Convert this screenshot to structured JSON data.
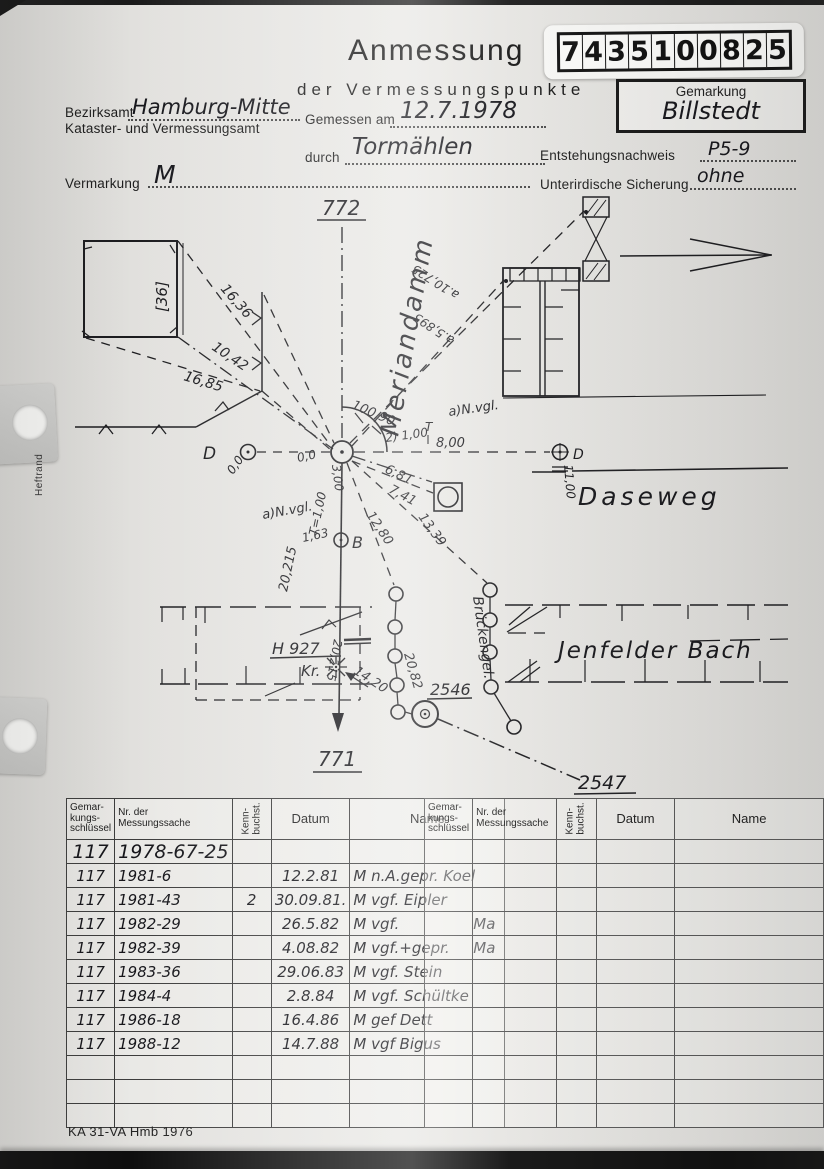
{
  "header": {
    "title_line1": "Anmessung",
    "title_line2": "der Vermessungspunkte",
    "stamp_digits": [
      "7",
      "4",
      "3",
      "5",
      "1",
      "0",
      "0",
      "8",
      "2",
      "5"
    ],
    "gemarkung_label": "Gemarkung",
    "gemarkung_value": "Billstedt",
    "bezirksamt_label": "Bezirksamt",
    "bezirksamt_value": "Hamburg-Mitte",
    "amt_label": "Kataster- und Vermessungsamt",
    "gemessen_label": "Gemessen am",
    "gemessen_value": "12.7.1978",
    "durch_label": "durch",
    "durch_value": "Tormählen",
    "vermarkung_label": "Vermarkung",
    "vermarkung_value": "M",
    "entstehung_label": "Entstehungsnachweis",
    "entstehung_value": "P5-9",
    "sicherung_label": "Unterirdische Sicherung",
    "sicherung_value": "ohne"
  },
  "margin": {
    "heftrand": "Heftrand"
  },
  "sketch": {
    "point_772": "772",
    "point_771": "771",
    "point_2546": "2546",
    "point_2547": "2547",
    "street_meriandamm": "Meriandamm",
    "street_daseweg": "Daseweg",
    "stream_name": "Jenfelder Bach",
    "bridge_abbr": "Brückengel.",
    "building_number": "[36]",
    "label_h927": "H 927",
    "label_kr": "Kr.",
    "label_b": "B",
    "label_d_left": "D",
    "label_d_right": "D",
    "angle_arc": "100,90",
    "note_2": "2) 1,00",
    "t_mark": "T",
    "nvgl_top": "a)N.vgl.",
    "nvgl_left": "a)N.vgl.",
    "t_100": "T=1,00",
    "m_16_36": "16,36",
    "m_10_42": "10,42",
    "m_16_85": "16,85",
    "m_8_00": "8,00",
    "m_6_81": "6,81",
    "m_7_41": "7,41",
    "m_12_80": "12,80",
    "m_13_39": "13,39",
    "m_10_725": "a.10,725",
    "m_5_895": "a.5,895",
    "m_0_0_left": "0,0",
    "m_0_0_center": "0,0",
    "m_3_00": "3,00",
    "m_1_63": "1,63",
    "m_20_215_a": "20,215",
    "m_20_215_b": "20,215",
    "m_11_00": "11,00",
    "m_14_20": "14,20",
    "m_20_82": "20,82"
  },
  "table": {
    "headers": {
      "col1": "Gemar-\nkungs-\nschlüssel",
      "col2": "Nr. der\nMessungssache",
      "col3": "Kenn-\nbuchst.",
      "col4": "Datum",
      "col5": "Name"
    },
    "rows": [
      {
        "s": "117",
        "nr": "1978-67-25",
        "k": "",
        "d": "",
        "n": "",
        "n2": ""
      },
      {
        "s": "117",
        "nr": "1981-6",
        "k": "",
        "d": "12.2.81",
        "n": "M n.A.gepr. Koel",
        "n2": ""
      },
      {
        "s": "117",
        "nr": "1981-43",
        "k": "2",
        "d": "30.09.81.",
        "n": "M vgf. Eipler",
        "n2": ""
      },
      {
        "s": "117",
        "nr": "1982-29",
        "k": "",
        "d": "26.5.82",
        "n": "M vgf.",
        "n2": "Ma"
      },
      {
        "s": "117",
        "nr": "1982-39",
        "k": "",
        "d": "4.08.82",
        "n": "M vgf.+gepr.",
        "n2": "Ma"
      },
      {
        "s": "117",
        "nr": "1983-36",
        "k": "",
        "d": "29.06.83",
        "n": "M vgf. Stein",
        "n2": ""
      },
      {
        "s": "117",
        "nr": "1984-4",
        "k": "",
        "d": "2.8.84",
        "n": "M vgf. Schültke",
        "n2": ""
      },
      {
        "s": "117",
        "nr": "1986-18",
        "k": "",
        "d": "16.4.86",
        "n": "M gef Dett",
        "n2": ""
      },
      {
        "s": "117",
        "nr": "1988-12",
        "k": "",
        "d": "14.7.88",
        "n": "M vgf Bigus",
        "n2": ""
      }
    ]
  },
  "footer": {
    "form_code": "KA 31-VA Hmb 1976"
  }
}
